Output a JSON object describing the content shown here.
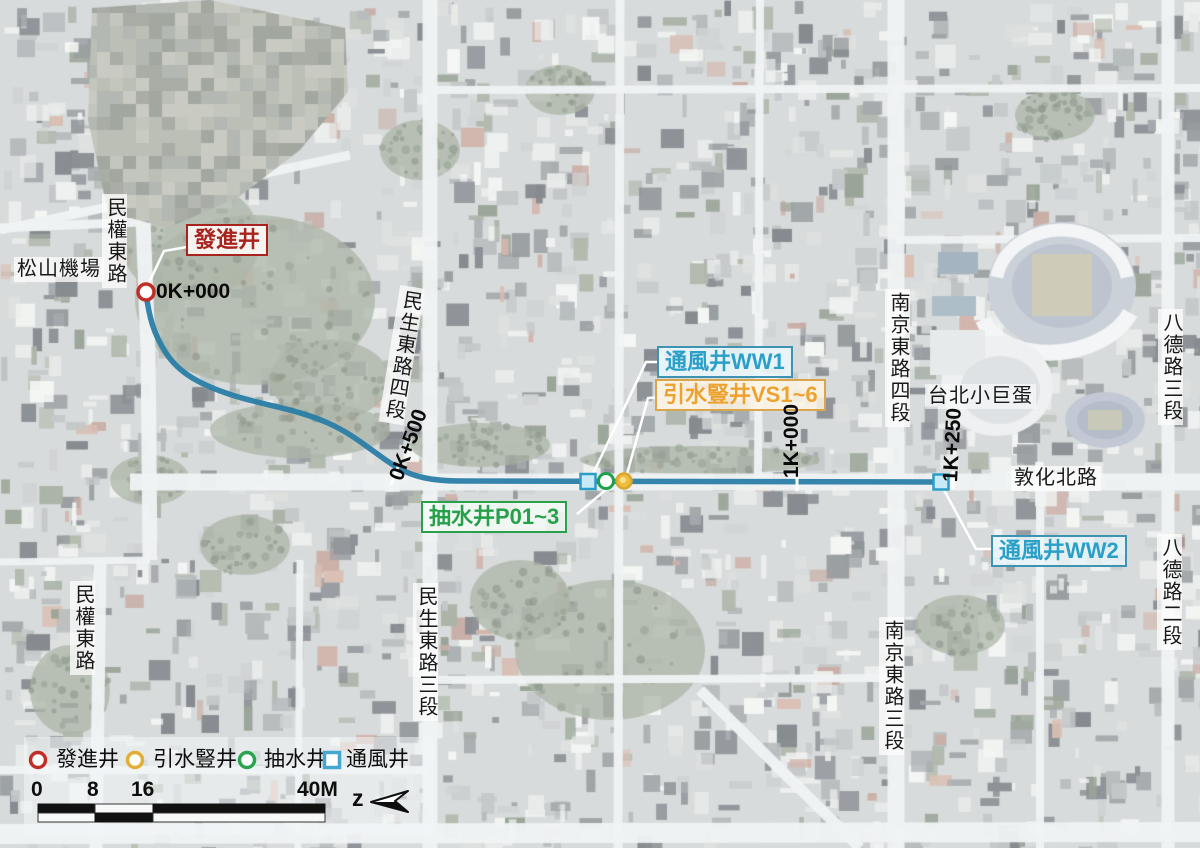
{
  "shafts": {
    "launch": {
      "text": "發進井"
    },
    "ww1": {
      "text": "通風井WW1"
    },
    "vs": {
      "text": "引水豎井VS1~6"
    },
    "pump": {
      "text": "抽水井P01~3"
    },
    "ww2": {
      "text": "通風井WW2"
    }
  },
  "chainage": {
    "c0": "0K+000",
    "c500": "0K+500",
    "c1000": "1K+000",
    "c1250": "1K+250"
  },
  "places": {
    "airport": "松山機場",
    "minquan_top": "民權東路",
    "minquan_bot": "民權東路",
    "minsheng4": "民生東路四段",
    "minsheng3": "民生東路三段",
    "nanjing4": "南京東路四段",
    "nanjing3": "南京東路三段",
    "bade3": "八德路三段",
    "bade2": "八德路二段",
    "dunhua": "敦化北路",
    "arena": "台北小巨蛋"
  },
  "legend": {
    "items": [
      {
        "symbol": "circle",
        "color": "#bf2f28",
        "label": "發進井"
      },
      {
        "symbol": "circle",
        "color": "#e2ae35",
        "label": "引水豎井"
      },
      {
        "symbol": "circle",
        "color": "#2aa44e",
        "label": "抽水井"
      },
      {
        "symbol": "square",
        "color": "#45a7cf",
        "label": "通風井"
      }
    ]
  },
  "scalebar": {
    "t0": "0",
    "t8": "8",
    "t16": "16",
    "t40": "40M"
  },
  "north_label": "z",
  "colors": {
    "tunnel": "#2a7da6",
    "launch": "#bf2f28",
    "vent": "#2d9cc6",
    "vent_fill": "#c8eaf6",
    "pump": "#1fa14c",
    "intake_fill": "#eebd3f",
    "intake_ring": "#d9a72e",
    "intake_core": "#f9e190",
    "leader": "#ffffff"
  }
}
